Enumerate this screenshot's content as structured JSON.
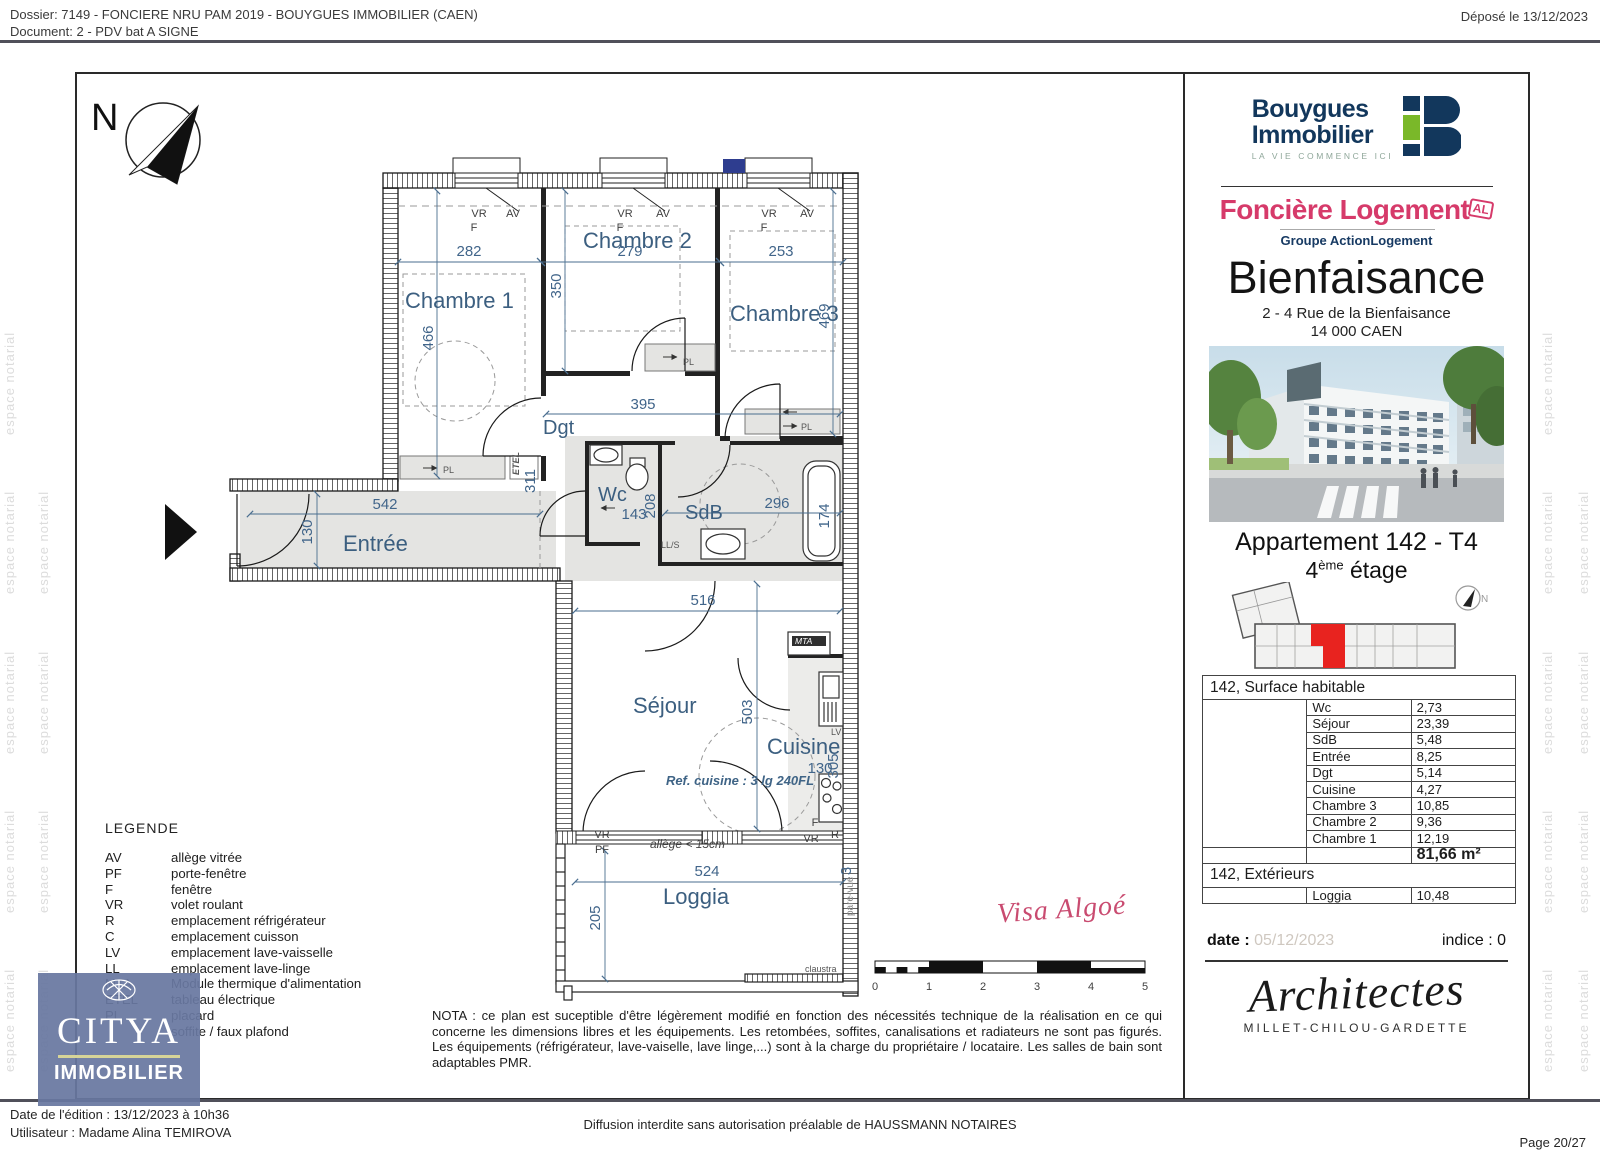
{
  "header": {
    "dossier_line": "Dossier: 7149 - FONCIERE NRU PAM 2019 - BOUYGUES IMMOBILIER (CAEN)",
    "document_line": "Document: 2 - PDV bat A SIGNE",
    "deposited": "Déposé le 13/12/2023"
  },
  "watermark": {
    "text": "espace notarial"
  },
  "plan": {
    "north": "N",
    "room_labels": {
      "chambre1": "Chambre 1",
      "chambre2": "Chambre 2",
      "chambre3": "Chambre 3",
      "dgt": "Dgt",
      "wc": "Wc",
      "sdb": "SdB",
      "entree": "Entrée",
      "sejour": "Séjour",
      "cuisine": "Cuisine",
      "loggia": "Loggia"
    },
    "dims": {
      "chambre1_w": "282",
      "chambre1_h": "466",
      "chambre2_w": "279",
      "chambre2_h": "350",
      "chambre3_w": "253",
      "chambre3_h": "469",
      "dgt_w": "395",
      "entree_w": "542",
      "entree_h": "130",
      "wc_w": "143",
      "wc_h": "208",
      "sdb_w": "296",
      "sdb_h": "174",
      "sejour_w": "516",
      "sejour_h": "503",
      "cuisine_w": "130",
      "cuisine_h": "305",
      "loggia_w": "524",
      "loggia_h": "205",
      "etel_dim": "311",
      "wall_dim": "3"
    },
    "tags": {
      "vr": "VR",
      "f": "F",
      "av": "AV",
      "pl": "PL",
      "etel": "ETEL",
      "lls": "LL/S",
      "mta": "MTA",
      "lv": "LV",
      "r": "R",
      "pf": "PF",
      "allege": "allège < 15cm",
      "ref_cuisine": "Ref. cuisine : 3 lg 240FL",
      "pare_vue": "pare-vue",
      "claustra": "claustra"
    },
    "scale_ticks": [
      "0",
      "1",
      "2",
      "3",
      "4",
      "5"
    ],
    "visa": "Visa Algoé"
  },
  "legend": {
    "title": "LEGENDE",
    "items": [
      {
        "abbr": "AV",
        "desc": "allège vitrée"
      },
      {
        "abbr": "PF",
        "desc": "porte-fenêtre"
      },
      {
        "abbr": "F",
        "desc": "fenêtre"
      },
      {
        "abbr": "VR",
        "desc": "volet roulant"
      },
      {
        "abbr": "R",
        "desc": "emplacement réfrigérateur"
      },
      {
        "abbr": "C",
        "desc": "emplacement cuisson"
      },
      {
        "abbr": "LV",
        "desc": "emplacement lave-vaisselle"
      },
      {
        "abbr": "LL",
        "desc": "emplacement lave-linge"
      },
      {
        "abbr": "MTA",
        "desc": "Module thermique d'alimentation"
      },
      {
        "abbr": "ETEL",
        "desc": "tableau électrique"
      },
      {
        "abbr": "PL",
        "desc": "placard"
      },
      {
        "abbr": "",
        "desc": "soffite / faux plafond"
      }
    ]
  },
  "nota": "NOTA : ce plan est suceptible d'être légèrement modifié en fonction des nécessités technique de la réalisation en ce qui concerne les dimensions libres et les équipements. Les retombées, soffites, canalisations et radiateurs ne sont pas figurés. Les équipements (réfrigérateur, lave-vaiselle, lave linge,...) sont à la charge du propriétaire / locataire. Les salles de bain sont adaptables PMR.",
  "sidebar": {
    "bouygues": {
      "name_line1": "Bouygues",
      "name_line2": "Immobilier",
      "tagline": "LA VIE COMMENCE ICI"
    },
    "fonciere": {
      "name": "Foncière Logement",
      "badge": "AL",
      "group": "Groupe ActionLogement"
    },
    "residence": {
      "name": "Bienfaisance",
      "address_line1": "2 - 4 Rue de la Bienfaisance",
      "address_line2": "14 000 CAEN"
    },
    "apartment": {
      "title": "Appartement 142 - T4",
      "floor_number": "4",
      "floor_sup": "ème",
      "floor_word": " étage",
      "keyplan_north": "N"
    },
    "surface_table": {
      "title": "142, Surface habitable",
      "rows": [
        [
          "Wc",
          "2,73"
        ],
        [
          "Séjour",
          "23,39"
        ],
        [
          "SdB",
          "5,48"
        ],
        [
          "Entrée",
          "8,25"
        ],
        [
          "Dgt",
          "5,14"
        ],
        [
          "Cuisine",
          "4,27"
        ],
        [
          "Chambre 3",
          "10,85"
        ],
        [
          "Chambre 2",
          "9,36"
        ],
        [
          "Chambre 1",
          "12,19"
        ]
      ],
      "total": "81,66 m²",
      "ext_title": "142, Extérieurs",
      "ext_rows": [
        [
          "Loggia",
          "10,48"
        ]
      ]
    },
    "date_label": "date :",
    "date_value": "05/12/2023",
    "indice": "indice : 0",
    "architects": {
      "script": "Architectes",
      "names": "MILLET-CHILOU-GARDETTE"
    }
  },
  "citya": {
    "name": "CITYA",
    "sub": "IMMOBILIER"
  },
  "footer": {
    "edition": "Date de l'édition : 13/12/2023 à 10h36",
    "user": "Utilisateur : Madame Alina TEMIROVA",
    "diffusion": "Diffusion interdite sans autorisation préalable de HAUSSMANN NOTAIRES",
    "page": "Page 20/27"
  }
}
